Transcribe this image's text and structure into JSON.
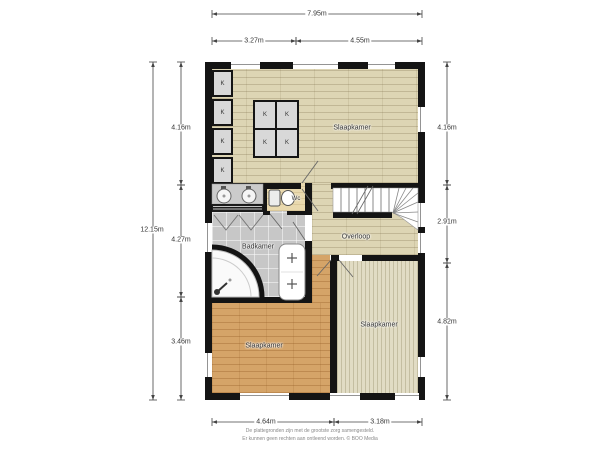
{
  "plan": {
    "rooms": {
      "bedroom_top": "Slaapkamer",
      "bedroom_bottom_left": "Slaapkamer",
      "bedroom_bottom_right": "Slaapkamer",
      "bathroom": "Badkamer",
      "toilet": "Wc",
      "landing": "Overloop"
    },
    "closet_label": "K",
    "dimensions": {
      "top_total": "7.95m",
      "top_left": "3.27m",
      "top_right": "4.55m",
      "left_total": "12.15m",
      "left_upper": "4.16m",
      "left_middle": "4.27m",
      "left_lower": "3.46m",
      "right_upper": "4.16m",
      "right_middle": "2.91m",
      "right_lower": "4.82m",
      "bottom_left": "4.64m",
      "bottom_right": "3.18m"
    },
    "colors": {
      "wall": "#141414",
      "wood_light": "#ddd5b4",
      "wood_orange": "#d5a468",
      "wood_pale": "#e1dcc4",
      "tile_gray": "#c7c7c7",
      "wc_floor": "#e9d9ae",
      "closet_fill": "#d8d8d8",
      "dimension_line": "#444444"
    },
    "footer": {
      "line1": "De plattegronden zijn met de grootste zorg samengesteld.",
      "line2": "Er kunnen geen rechten aan ontleend worden. © BOO Media"
    }
  }
}
